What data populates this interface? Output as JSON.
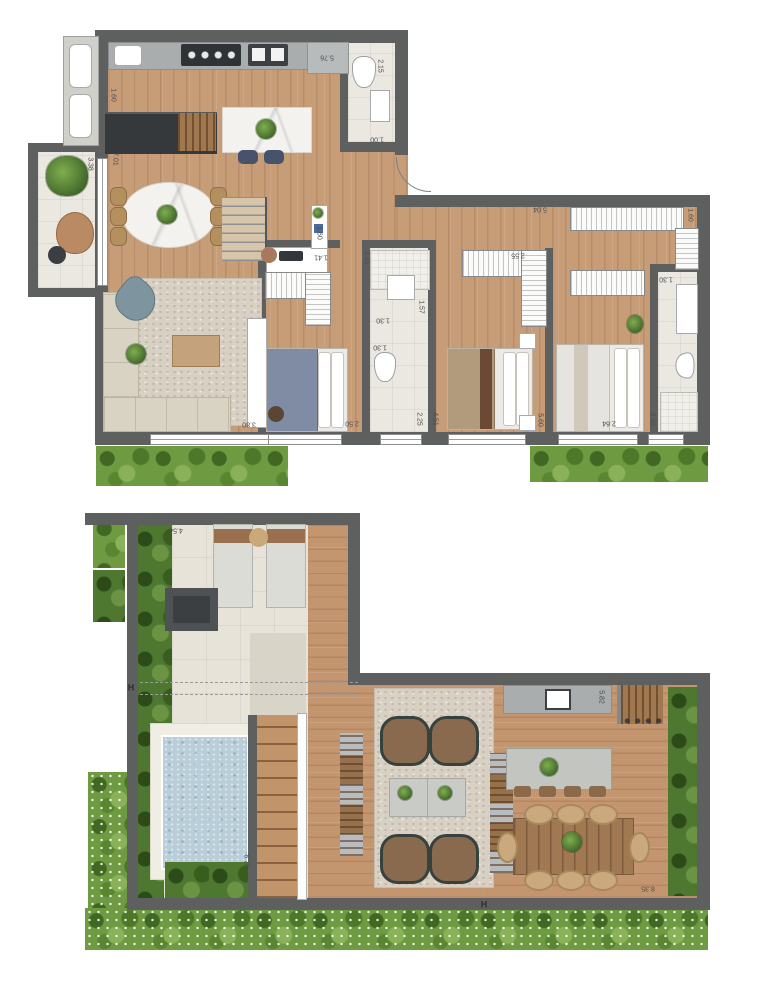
{
  "document": {
    "type": "residential floor plan, two levels",
    "units": "m"
  },
  "colors": {
    "wall": "#5e6060",
    "wood_floor": "#c79d78",
    "tile_floor": "#ebe8e2",
    "greenery": "#6e9a41",
    "pool_water": "#b9ced8",
    "counter_gray": "#a9adad",
    "island_dark": "#35393b",
    "marble": "#f3f2ef"
  },
  "upper_plan": {
    "dimensions": [
      {
        "value": "5.76",
        "x": 327,
        "y": 57,
        "rot": 180
      },
      {
        "value": "2.15",
        "x": 380,
        "y": 66,
        "rot": 90
      },
      {
        "value": "1.00",
        "x": 377,
        "y": 139,
        "rot": 180
      },
      {
        "value": "1.60",
        "x": 113,
        "y": 95,
        "rot": 90
      },
      {
        "value": "3.38",
        "x": 90,
        "y": 164,
        "rot": 90
      },
      {
        "value": "7.01",
        "x": 115,
        "y": 159,
        "rot": 90
      },
      {
        "value": "1.60",
        "x": 319,
        "y": 233,
        "rot": 90
      },
      {
        "value": "1.41",
        "x": 321,
        "y": 257,
        "rot": 180
      },
      {
        "value": "5.04",
        "x": 540,
        "y": 209,
        "rot": 180
      },
      {
        "value": "2.55",
        "x": 518,
        "y": 255,
        "rot": 180
      },
      {
        "value": "1.60",
        "x": 690,
        "y": 215,
        "rot": 90
      },
      {
        "value": "4.51",
        "x": 366,
        "y": 258,
        "rot": 90
      },
      {
        "value": "1.57",
        "x": 421,
        "y": 307,
        "rot": 90
      },
      {
        "value": "1.30",
        "x": 383,
        "y": 320,
        "rot": 180
      },
      {
        "value": "1.30",
        "x": 380,
        "y": 347,
        "rot": 180
      },
      {
        "value": "1.30",
        "x": 666,
        "y": 279,
        "rot": 180
      },
      {
        "value": "2.25",
        "x": 419,
        "y": 419,
        "rot": 90
      },
      {
        "value": "4.51",
        "x": 435,
        "y": 419,
        "rot": 90
      },
      {
        "value": "3.80",
        "x": 249,
        "y": 424,
        "rot": 180
      },
      {
        "value": "2.50",
        "x": 352,
        "y": 423,
        "rot": 180
      },
      {
        "value": "5.60",
        "x": 540,
        "y": 420,
        "rot": 90
      },
      {
        "value": "2.64",
        "x": 609,
        "y": 423,
        "rot": 180
      },
      {
        "value": "3.90",
        "x": 652,
        "y": 419,
        "rot": 90
      }
    ]
  },
  "lower_plan": {
    "dimensions": [
      {
        "value": "4.54",
        "x": 176,
        "y": 530,
        "rot": 180
      },
      {
        "value": "8.70",
        "x": 246,
        "y": 861,
        "rot": 90
      },
      {
        "value": "5.82",
        "x": 601,
        "y": 697,
        "rot": 90
      },
      {
        "value": "8.35",
        "x": 648,
        "y": 888,
        "rot": 180
      }
    ],
    "section_markers": [
      {
        "label": "H",
        "x": 131,
        "y": 688
      },
      {
        "label": "H",
        "x": 484,
        "y": 905
      }
    ]
  }
}
